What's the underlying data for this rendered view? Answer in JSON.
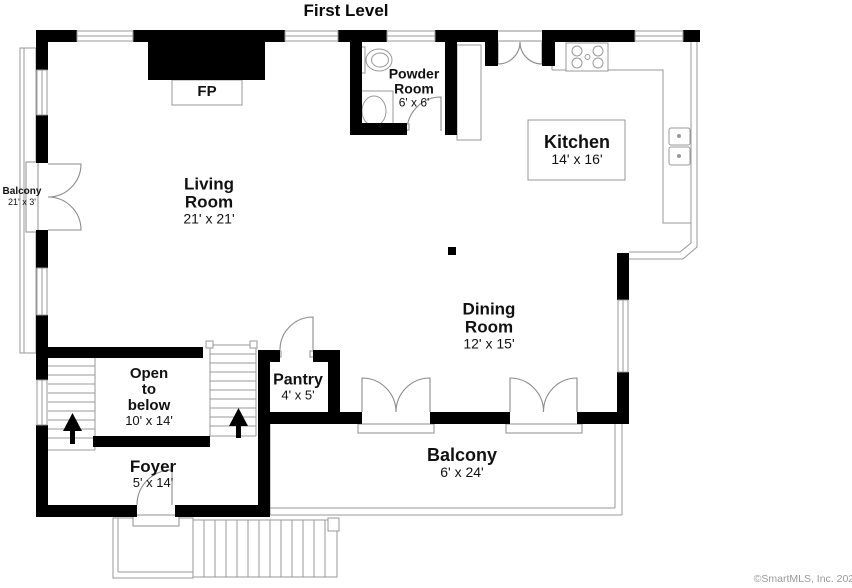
{
  "title": "First Level",
  "watermark": "©SmartMLS, Inc. 2022",
  "rooms": {
    "living": {
      "line1": "Living",
      "line2": "Room",
      "dims": "21' x 21'"
    },
    "powder": {
      "line1": "Powder",
      "line2": "Room",
      "dims": "6' x 6'"
    },
    "kitchen": {
      "name": "Kitchen",
      "dims": "14' x 16'"
    },
    "dining": {
      "line1": "Dining",
      "line2": "Room",
      "dims": "12' x 15'"
    },
    "open_below": {
      "line1": "Open",
      "line2": "to",
      "line3": "below",
      "dims": "10' x 14'"
    },
    "pantry": {
      "name": "Pantry",
      "dims": "4' x 5'"
    },
    "foyer": {
      "name": "Foyer",
      "dims": "5' x 14'"
    },
    "balcony_left": {
      "name": "Balcony",
      "dims": "21' x 3'"
    },
    "balcony_rear": {
      "name": "Balcony",
      "dims": "6' x 24'"
    }
  },
  "fixtures": {
    "fireplace_label": "FP",
    "icons": [
      "fireplace-icon",
      "toilet-icon",
      "vanity-sink-icon",
      "cooktop-icon",
      "kitchen-double-sink-icon",
      "stairs-up-arrow-icon",
      "french-door-icon",
      "window-icon"
    ]
  },
  "colors": {
    "background": "#ffffff",
    "walls": "#000000",
    "thin_lines": "#999999",
    "door_arcs": "#8c8c8c",
    "text": "#111111",
    "watermark": "#9a9a9a"
  }
}
